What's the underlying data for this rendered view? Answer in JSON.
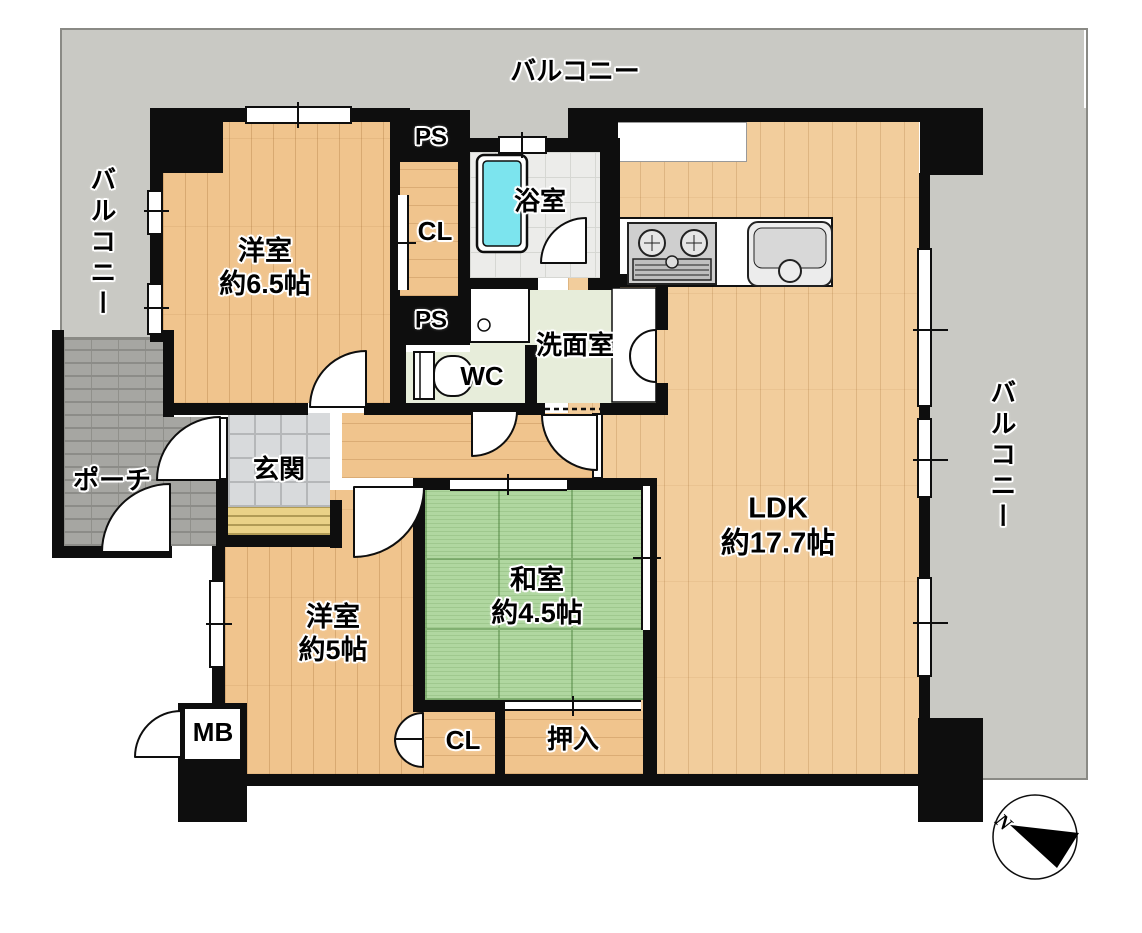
{
  "balcony": {
    "top": "バルコニー",
    "left": "バルコニー",
    "right": "バルコニー"
  },
  "rooms": {
    "western_6_5": {
      "name": "洋室",
      "size": "約6.5帖"
    },
    "western_5": {
      "name": "洋室",
      "size": "約5帖"
    },
    "japanese_4_5": {
      "name": "和室",
      "size": "約4.5帖"
    },
    "ldk": {
      "name": "LDK",
      "size": "約17.7帖"
    },
    "bathroom": "浴室",
    "washroom": "洗面室",
    "toilet": "WC",
    "entrance": "玄関",
    "porch": "ポーチ"
  },
  "storage": {
    "closet_upper": "CL",
    "closet_lower": "CL",
    "oshiire": "押入"
  },
  "utilities": {
    "ps_upper": "PS",
    "ps_lower": "PS",
    "meter_box": "MB"
  },
  "compass": {
    "north": "N"
  },
  "colors": {
    "wall": "#0e0e0e",
    "wood_floor": "#f0c48d",
    "ldk_floor": "#f2cd9c",
    "tatami": "#b0d7a0",
    "bath_tile": "#ececea",
    "wet_floor": "#e7edda",
    "entrance_tile": "#d8dadc",
    "porch_brick": "#a6a6a2",
    "balcony": "#c9c9c4",
    "bathtub": "#7ce4ee",
    "entrance_step": "#ead287"
  }
}
